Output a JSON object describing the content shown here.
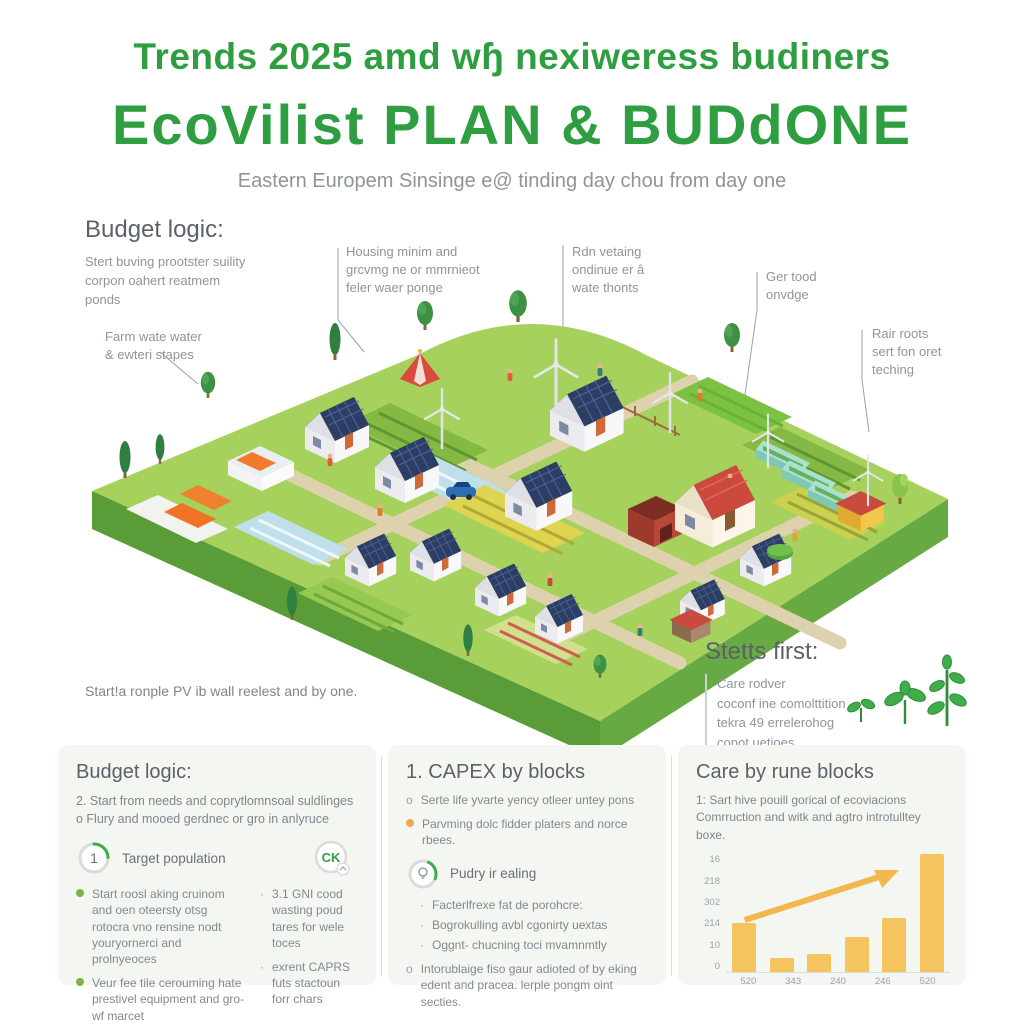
{
  "colors": {
    "accent_green": "#2f9e41",
    "bar_orange": "#f6c45e",
    "text_gray": "#8e959c"
  },
  "header": {
    "title_line1": "Trends 2025 amd wɧ nexiweress budiners",
    "title_line2": "EcoVilist PLAN & BUDdONE",
    "subtitle": "Eastern Europem Sinsinge e@ tinding day chou from day one"
  },
  "top_left": {
    "heading": "Budget logic:",
    "body": "Stert buving prootster suility\ncorpon oahert reatmem\nponds"
  },
  "callouts": {
    "farm_water": "Farm wate water\n& ewteri stapes",
    "housing": "Housing minim and\ngrcvmg ne or mmrnieot\nfeler waer ponge",
    "rain": "Rdn vetaing\nondinue er â\nwate thonts",
    "food": "Ger tood\nonvdge",
    "roots": "Rair roots\nsert fon oret\nteching"
  },
  "caption_left": "Start!a ronple PV ib wall reelest and by one.",
  "stetts": {
    "heading": "Stetts first:",
    "lines": [
      "Care rodver",
      "coconf ine comolttition",
      "tekra 49 errelerohog",
      "conot uetioes"
    ]
  },
  "panel_budget": {
    "heading": "Budget logic:",
    "intro": [
      "2. Start from needs and coprytlomnsoal suldlinges",
      "o Flury and mooed gerdnec or gro in anlyruce"
    ],
    "step_number": "1",
    "step_label": "Target population",
    "bullets": [
      "Start roosl aking cruinom and oen oteersty otsg rotocra vno rensine nodt youryornerci and prolnyeoces",
      "Veur fee tile cerouming hate prestivel equipment and gro-wf marcet"
    ],
    "badge": "CK",
    "side_marker": "·",
    "side_bullets": [
      "3.1 GNI cood wasting poud tares for wele toces",
      "exrent CAPRS futs stactoun forr chars"
    ]
  },
  "panel_capex": {
    "heading": "1. CAPEX by blocks",
    "bullets": [
      {
        "marker": "o",
        "text": "Serte life yvarte yency otleer untey pons"
      },
      {
        "marker": "",
        "text": "Parvming dolc fidder platers and norce rbees."
      }
    ],
    "step_label": "Pudry ir ealing",
    "sub_marker": "·",
    "sub_bullets": [
      "Facterlfrexe fat de porohcre:",
      "Bogrokulling avbl cgonirty uextas",
      "Oggnt- chucning toci mvamnmtly"
    ],
    "final_marker": "o",
    "final_text": "Intorublaige fiso gaur adioted of by eking edent and pracea. lerple pongm oint secties."
  },
  "panel_care": {
    "heading": "Care by rune blocks",
    "body": "1: Sart hive pouill gorical of ecoviacions Comrruction and witk and agtro introtulltey boxe."
  },
  "chart_data": {
    "type": "bar",
    "title": "",
    "xlabel": "",
    "ylabel": "",
    "x_tick_labels": [
      "520",
      "343",
      "240",
      "246",
      "520"
    ],
    "values": [
      42,
      12,
      15,
      30,
      46,
      100
    ],
    "y_tick_labels_top_to_bottom": [
      "16",
      "218",
      "302",
      "214",
      "10",
      "0"
    ],
    "ylim": [
      0,
      100
    ],
    "grid": false,
    "legend": false,
    "bar_color": "#f6c45e",
    "arrow_color": "#f2b84e",
    "trend_arrow": "up-right"
  }
}
